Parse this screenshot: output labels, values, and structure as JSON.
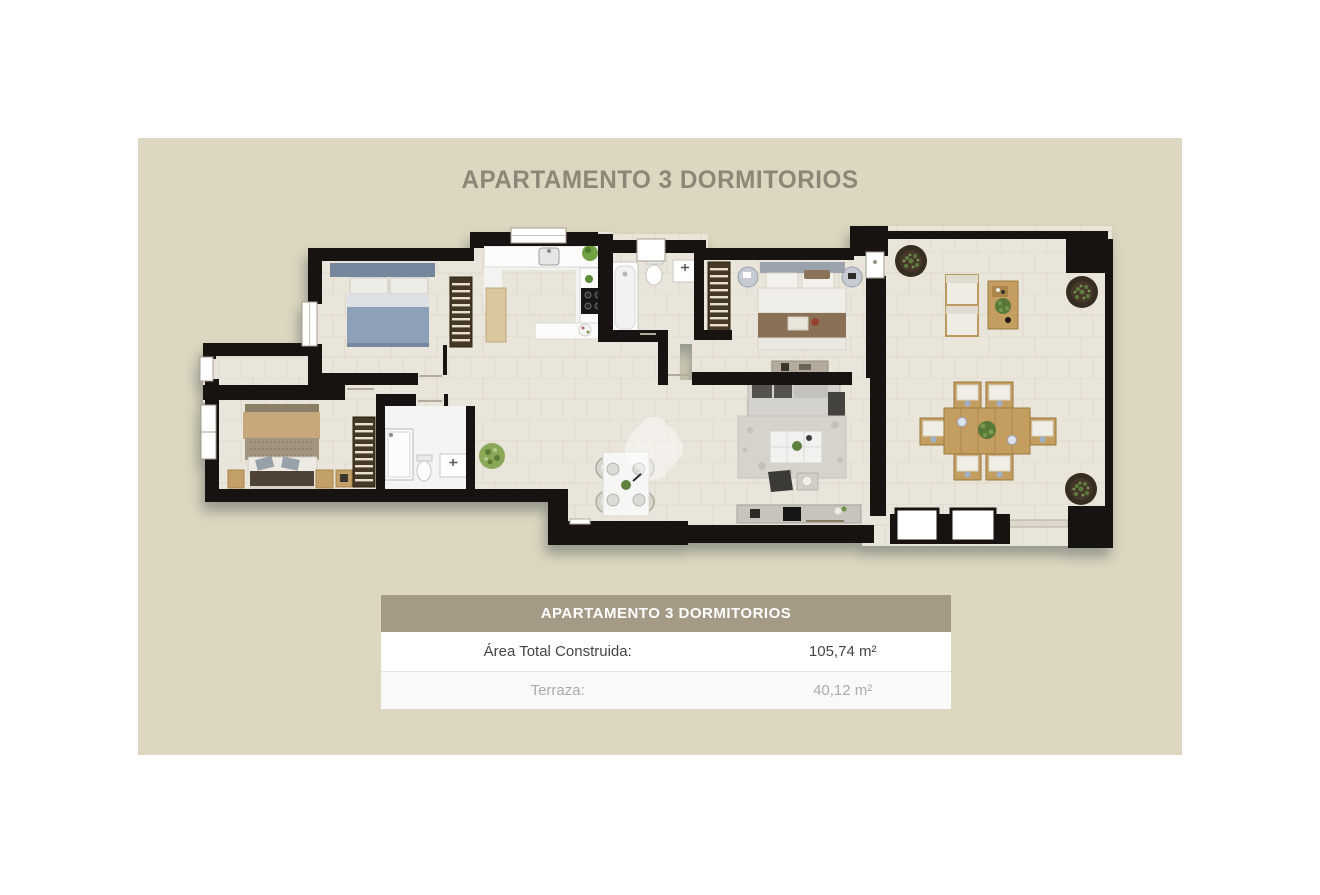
{
  "title": "APARTAMENTO 3 DORMITORIOS",
  "info_table": {
    "header": "APARTAMENTO 3 DORMITORIOS",
    "rows": [
      {
        "label": "Área Total Construida:",
        "value": "105,74 m²"
      },
      {
        "label": "Terraza:",
        "value": "40,12 m²"
      }
    ]
  },
  "colors": {
    "page_background": "#ffffff",
    "panel_background": "#ddd6c0",
    "title_text": "#8d8779",
    "table_header_background": "#a49a86",
    "table_header_text": "#ffffff",
    "table_row_text": "#454545",
    "table_row_muted_text": "#a8abad",
    "table_row_alt_background": "#f8f9f9",
    "plan_walls": "#161310",
    "plan_floor": "#eae5db",
    "plan_white_floor": "#f3f3f1",
    "bed_blue": "#8da0b8",
    "bed_brown_blanket": "#8a7054",
    "bed_tan": "#c7a87c",
    "terrace_wood": "#c49e60",
    "plant_green": "#5d7c3a",
    "sofa_gray": "#d4d2cd"
  },
  "floorplan": {
    "icons": [
      "double-bed-blue",
      "double-bed-brown",
      "double-bed-tan",
      "wardrobe",
      "kitchen-counter",
      "kitchen-sink",
      "stove",
      "kitchen-island",
      "bathtub",
      "toilet",
      "washbasin",
      "shower",
      "sofa",
      "rug",
      "coffee-table",
      "tv-console",
      "dining-table",
      "lounge-chairs",
      "outdoor-dining-table",
      "potted-plant",
      "clover-watermark"
    ]
  }
}
